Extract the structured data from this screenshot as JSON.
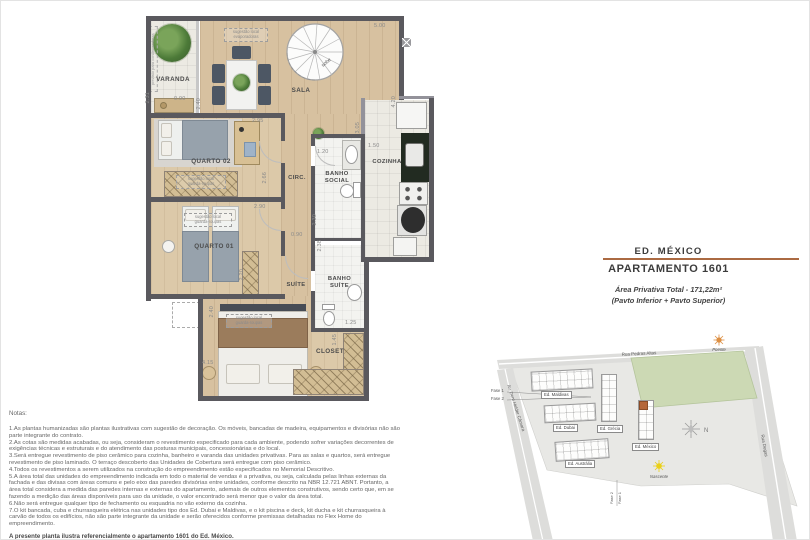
{
  "title_block": {
    "building": "ED. MÉXICO",
    "apartment": "APARTAMENTO 1601",
    "area_total": "Área Privativa Total - 171,22m²",
    "area_pavtos": "(Pavto Inferior + Pavto Superior)",
    "divider_color": "#ab6a42"
  },
  "floor_plan": {
    "rooms": {
      "varanda": "VARANDA",
      "sala": "SALA",
      "cozinha": "COZINHA",
      "quarto02": "QUARTO 02",
      "quarto01": "QUARTO 01",
      "circ": "CIRC.",
      "banho_social": "BANHO\nSOCIAL",
      "suite": "SUÍTE",
      "banho_suite": "BANHO\nSUÍTE",
      "closet": "CLOSET"
    },
    "annotations": {
      "stair_up": "sobe",
      "ac_previsao": "previsto para condensadoras",
      "ac_sugestao": "sugestão local\nevaporadoras",
      "wardrobe_q2": "sugestão local\nguarda-roupas",
      "wardrobe_q1": "sugestão local\nguarda-roupas",
      "wardrobe_suite": "sugestão local\nguarda-roupas"
    },
    "dims": [
      "5.00",
      "0.90",
      "2.31",
      "2.40",
      "2.95",
      "4.20",
      "3.05",
      "1.50",
      "1.20",
      "2.66",
      "2.90",
      "2.30",
      "2.38",
      "0.90",
      "2.20",
      "2.40",
      "4.15",
      "1.25",
      "1.45"
    ]
  },
  "site_plan": {
    "streets": {
      "top": "Rua Pedras Altas",
      "left": "Av. Dom Helder Câmara",
      "right": "Rua Degas"
    },
    "buildings": {
      "maldivas": "Ed. Maldivas",
      "dubai": "Ed. Dubai",
      "grecia": "Ed. Grécia",
      "mexico": "Ed. México",
      "australia": "Ed. Austrália"
    },
    "suns": {
      "poente": "Poente",
      "nascente": "Nascente"
    },
    "compass": "N",
    "phases": {
      "fase1": "Fase 1",
      "fase2": "Fase 2"
    },
    "highlight_color": "#b4663a"
  },
  "notes": {
    "heading": "Notas:",
    "items": [
      "1.As plantas humanizadas são plantas ilustrativas com sugestão de decoração. Os móveis, bancadas de madeira, equipamentos e divisórias não são parte integrante do contrato.",
      "2.As cotas são medidas acabadas, ou seja, consideram o revestimento especificado para cada ambiente, podendo sofrer variações decorrentes de exigências técnicas e estruturais e do atendimento das posturas municipais, concessionárias e do local.",
      "3.Será entregue revestimento de piso cerâmico para cozinha, banheiro e varanda das unidades privativas. Para as salas e quartos, será entregue revestimento de piso laminado. O terraço descoberto das Unidades de Cobertura será entregue com piso cerâmico.",
      "4.Todos os revestimentos a serem utilizados na construção do empreendimento estão especificados no Memorial Descritivo.",
      "5.A área total das unidades do empreendimento indicada em todo o material de vendas é a privativa, ou seja, calculada pelas linhas externas da fachada e das divisas com áreas comuns e pelo eixo das paredes divisórias entre unidades, conforme descrito na NBR 12.721 ABNT. Portanto, a área total considera a medida das paredes internas e externas do apartamento, ademais de outros elementos construtivos, sendo certo que, em se fazendo a medição das áreas disponíveis para uso da unidade, o valor encontrado será menor que o valor da área total.",
      "6.Não será entregue qualquer tipo de fechamento ou esquadria no vão externo da cozinha.",
      "7.O kit bancada, cuba e churrasqueira elétrica nas unidades tipo dos Ed. Dubai e Maldivas, e o kit piscina e deck, kit ducha e kit churrasqueira à carvão de todos os edifícios, não são parte integrante da unidade e serão oferecidos conforme premissas detalhadas no Flex Home do empreendimento."
    ],
    "footer": "A presente planta ilustra referencialmente o apartamento 1601 do Ed. México."
  }
}
